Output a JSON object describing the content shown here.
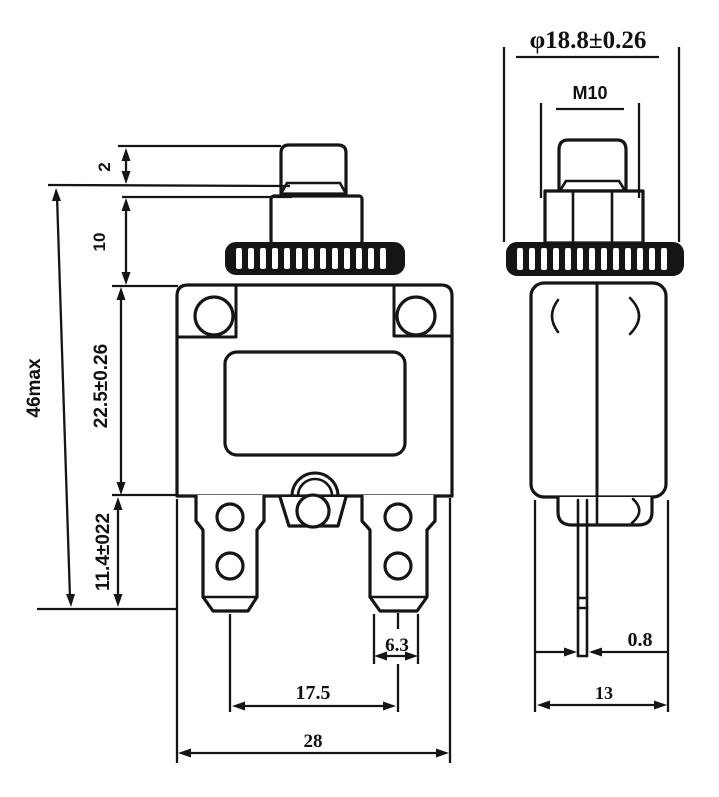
{
  "drawing": {
    "background": "#ffffff",
    "line_color": "#151515",
    "labels": {
      "knurl_diameter": "φ18.8±0.26",
      "thread_size": "M10",
      "button_height": "2",
      "bushing_height": "10",
      "total_height": "46max",
      "body_height": "22.5±0.26",
      "terminal_height": "11.4±022",
      "terminal_tip_width": "6.3",
      "terminal_spacing": "17.5",
      "body_width": "28",
      "blade_thickness": "0.8",
      "body_depth": "13"
    }
  }
}
